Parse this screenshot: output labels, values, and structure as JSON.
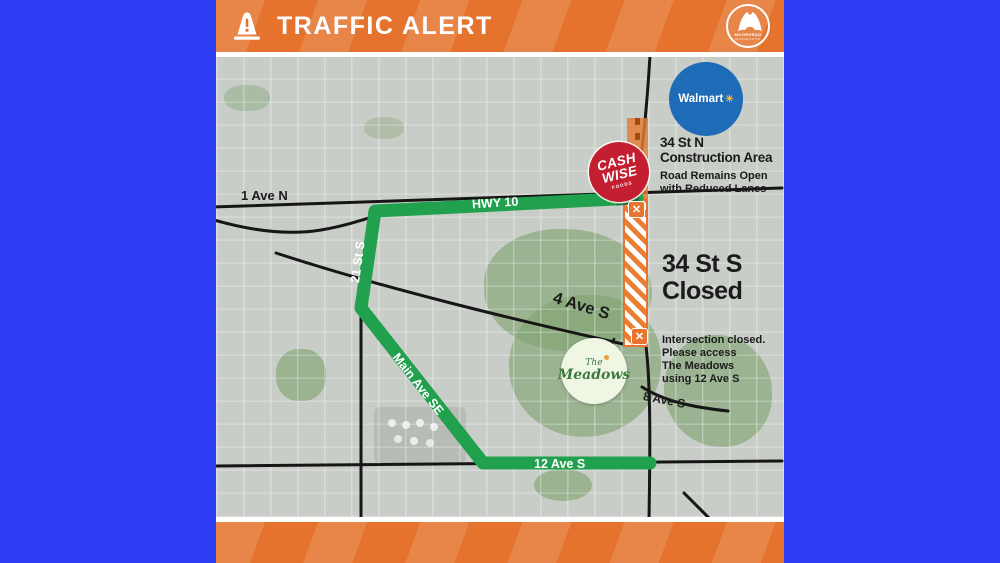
{
  "colors": {
    "page_background": "#2c3cf2",
    "band_orange": "#e5732e",
    "route_green": "#21a14d",
    "closure_orange": "#e87430",
    "walmart_blue": "#1e6bb8",
    "cashwise_red": "#c41f30"
  },
  "header": {
    "title": "TRAFFIC ALERT",
    "city_logo_name": "MOORHEAD",
    "city_logo_sub": "MINNESOTA"
  },
  "map": {
    "labels": {
      "ave1n": "1 Ave N",
      "hwy10": "HWY 10",
      "st21s": "21 St S",
      "ave4s": "4 Ave S",
      "mainavese": "Main Ave SE",
      "ave8s": "8 Ave S",
      "ave12s": "12 Ave S"
    },
    "construction_note": {
      "title1": "34 St N",
      "title2": "Construction Area",
      "sub1": "Road Remains Open",
      "sub2": "with Reduced Lanes"
    },
    "closed_note": {
      "line1": "34 St S",
      "line2": "Closed"
    },
    "intersection_note": {
      "line1": "Intersection closed.",
      "line2": "Please access",
      "line3": "The Meadows",
      "line4": "using 12 Ave S"
    },
    "markers": {
      "x_glyph": "✕"
    },
    "logos": {
      "walmart": {
        "name": "Walmart",
        "spark": "✳"
      },
      "cashwise": {
        "line1": "CASH",
        "line2": "WISE",
        "tagline": "FOODS"
      },
      "meadows": {
        "line1": "The",
        "line2": "Meadows"
      }
    }
  }
}
